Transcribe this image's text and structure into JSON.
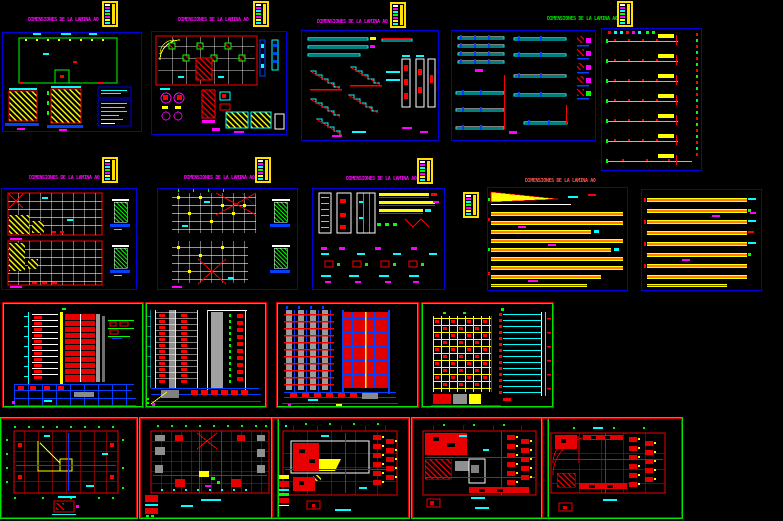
{
  "window": {
    "width": 783,
    "height": 521,
    "background": "#000000",
    "app": "cad-drawing-preview"
  },
  "palette": {
    "panel_border_blue": "#0000e0",
    "panel_border_green": "#00e400",
    "panel_border_red": "#e40000",
    "title_magenta": "#ff00ff",
    "title_green": "#00dd00",
    "title_red": "#ff5050",
    "cad_yellow": "#ffff00",
    "cad_cyan": "#00ffff",
    "cad_red": "#ff0000",
    "cad_green": "#00ff00",
    "cad_blue": "#0040ff",
    "cad_magenta": "#ff00ff",
    "cad_white": "#ffffff",
    "cad_gray": "#9a9a9a"
  },
  "sheet_labels": [
    {
      "text": "DIMENSIONES DE LA LAMINA A0",
      "color": "#ff00ff"
    },
    {
      "text": "DIMENSIONES DE LA LAMINA A0",
      "color": "#ff00ff"
    },
    {
      "text": "DIMENSIONES DE LA LAMINA A0",
      "color": "#ff00ff"
    },
    {
      "text": "DIMENSIONES DE LA LAMINA A0",
      "color": "#00dd00"
    },
    {
      "text": "DIMENSIONES DE LA LAMINA A0",
      "color": "#ff00ff"
    },
    {
      "text": "DIMENSIONES DE LA LAMINA A0",
      "color": "#ff00ff"
    },
    {
      "text": "DIMENSIONES DE LA LAMINA A0",
      "color": "#ff00ff"
    },
    {
      "text": "DIMENSIONES DE LA LAMINA A0",
      "color": "#ff5050"
    }
  ],
  "panels": [
    {
      "id": "p1",
      "row": 1,
      "border": "#0000e0"
    },
    {
      "id": "p2",
      "row": 1,
      "border": "#0000e0"
    },
    {
      "id": "p3",
      "row": 1,
      "border": "#0000e0"
    },
    {
      "id": "p4",
      "row": 1,
      "border": "#0000e0"
    },
    {
      "id": "p5",
      "row": 1,
      "border": "#0000e0"
    },
    {
      "id": "p6",
      "row": 2,
      "border": "#0000e0"
    },
    {
      "id": "p7",
      "row": 2,
      "border": "#0000e0"
    },
    {
      "id": "p8",
      "row": 2,
      "border": "#0000e0"
    },
    {
      "id": "p9",
      "row": 2,
      "border": "#0000e0"
    },
    {
      "id": "p10",
      "row": 2,
      "border": "#0000e0"
    },
    {
      "id": "e1",
      "row": 3,
      "border": "#e40000/#00e400"
    },
    {
      "id": "e2",
      "row": 3,
      "border": "#e40000/#00e400"
    },
    {
      "id": "e3",
      "row": 3,
      "border": "#e40000/#00e400"
    },
    {
      "id": "e4",
      "row": 3,
      "border": "#e40000/#00e400"
    },
    {
      "id": "f1",
      "row": 4,
      "border": "#00e400/#e40000"
    },
    {
      "id": "f2",
      "row": 4,
      "border": "#00e400/#e40000"
    },
    {
      "id": "f3",
      "row": 4,
      "border": "#00e400/#e40000"
    },
    {
      "id": "f4",
      "row": 4,
      "border": "#00e400/#e40000"
    },
    {
      "id": "f5",
      "row": 4,
      "border": "#00e400/#e40000"
    }
  ]
}
